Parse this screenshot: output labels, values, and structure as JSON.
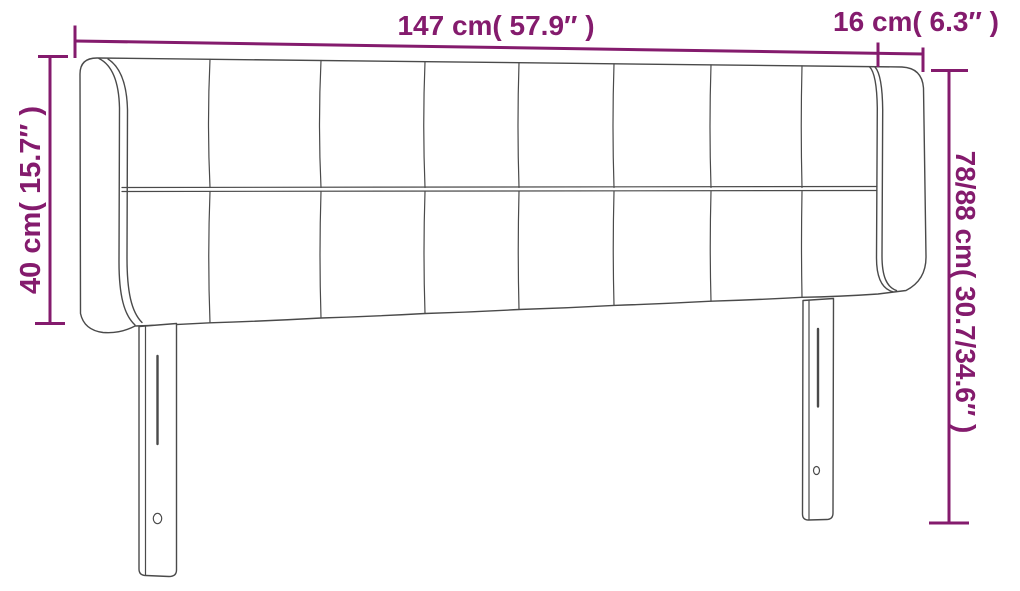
{
  "labels": {
    "top_width": "147 cm( 57.9″ )",
    "overhang_width": "16 cm( 6.3″ )",
    "left_height": "40 cm( 15.7″ )",
    "right_height": "78/88 cm( 30.7/34.6″ )"
  },
  "measurements": {
    "total_width_cm": "147",
    "total_width_in": "57.9",
    "wing_depth_cm": "16",
    "wing_depth_in": "6.3",
    "panel_height_cm": "40",
    "panel_height_in": "15.7",
    "overall_height_cm": "78/88",
    "overall_height_in": "30.7/34.6"
  },
  "drawing": {
    "subject": "upholstered headboard with side wings and two legs",
    "tuft_columns": 8,
    "tuft_rows": 2,
    "legs": 2
  },
  "colors": {
    "accent": "#841b6d",
    "outline": "#4a4a4a",
    "background": "#ffffff"
  }
}
